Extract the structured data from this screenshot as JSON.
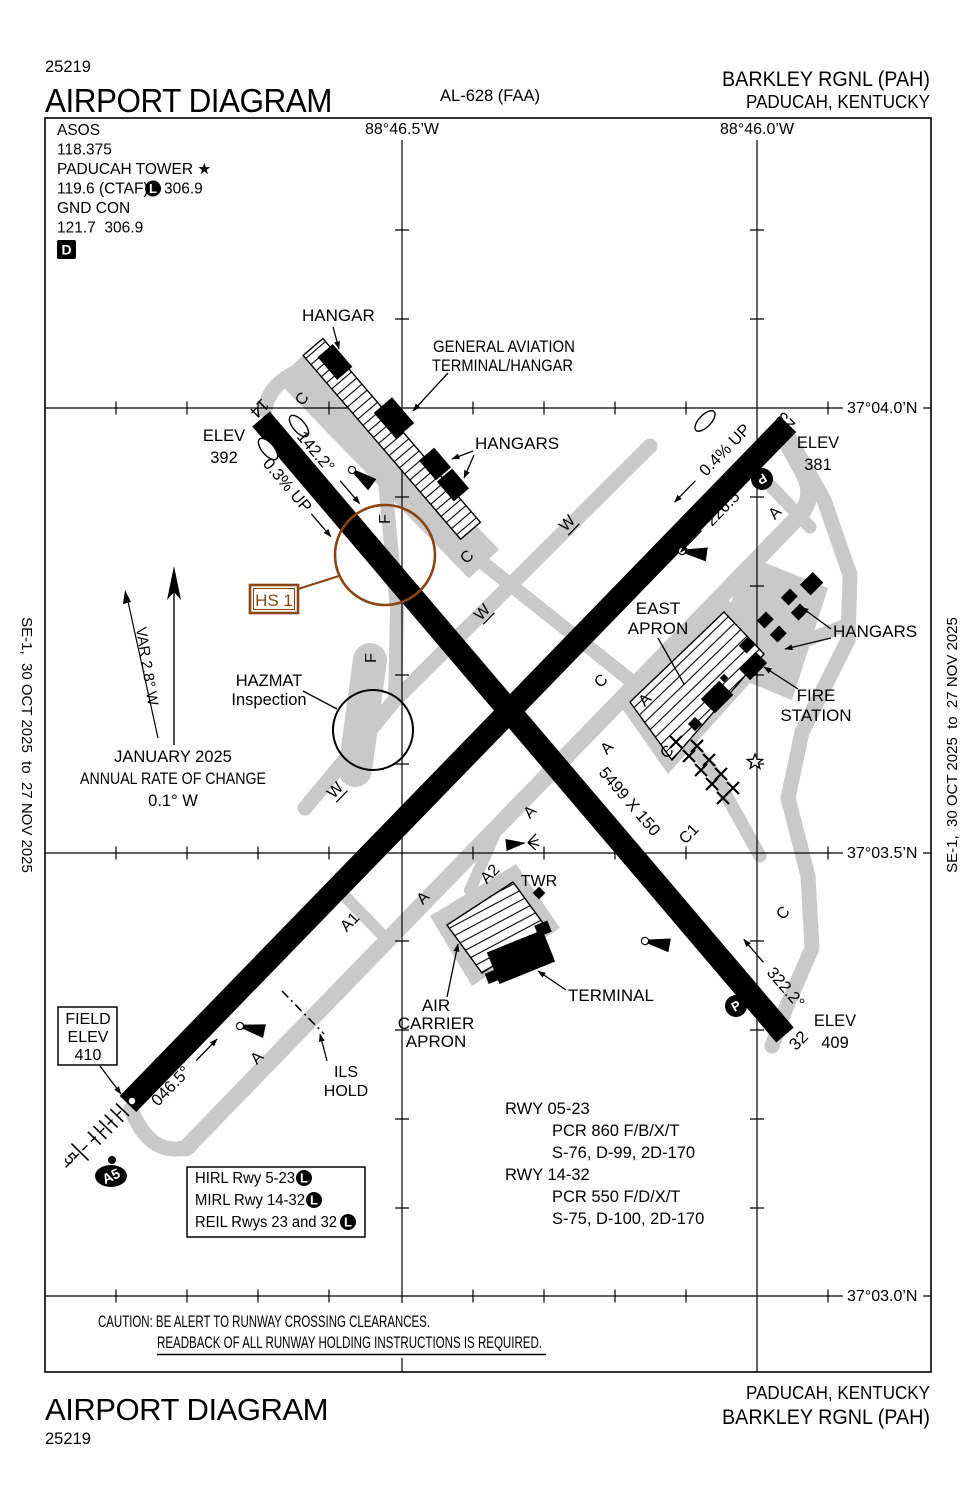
{
  "colors": {
    "hotspot_brown": "#8b4513",
    "taxiway_gray": "#c9c9c9",
    "ink": "#000000"
  },
  "header": {
    "chart_number": "25219",
    "title": "AIRPORT DIAGRAM",
    "al_ref": "AL-628 (FAA)",
    "airport": "BARKLEY RGNL (PAH)",
    "city": "PADUCAH, KENTUCKY"
  },
  "footer": {
    "title": "AIRPORT DIAGRAM",
    "chart_number": "25219",
    "city": "PADUCAH, KENTUCKY",
    "airport": "BARKLEY RGNL (PAH)"
  },
  "edition": {
    "note": "SE-1,  30 OCT 2025  to  27 NOV 2025"
  },
  "comm": {
    "asos_label": "ASOS",
    "asos_freq": "118.375",
    "tower_label": "PADUCAH TOWER ★",
    "tower_freq": "119.6 (CTAF)",
    "lighted": "L",
    "tower_freq_uhf": "306.9",
    "gnd_label": "GND CON",
    "gnd_freq": "121.7  306.9",
    "datis": "D"
  },
  "graticule": {
    "lon_465": "88°46.5’W",
    "lon_460": "88°46.0’W",
    "lat_040": "37°04.0’N",
    "lat_035": "37°03.5’N",
    "lat_030": "37°03.0’N"
  },
  "variation": {
    "var": "VAR 2.8° W",
    "date": "JANUARY 2025",
    "rate1": "ANNUAL RATE OF CHANGE",
    "rate2": "0.1° W"
  },
  "field": {
    "l1": "FIELD",
    "l2": "ELEV",
    "l3": "410"
  },
  "elevations": {
    "elev": "ELEV",
    "rwy14": "392",
    "rwy23": "381",
    "rwy32": "409"
  },
  "runways": {
    "num5": "5",
    "num14": "14",
    "num23": "23",
    "num32": "32",
    "hdg05": "046.5°",
    "hdg14": "142.2°",
    "hdg23": "226.5°",
    "hdg32": "322.2°",
    "slope14": "0.3% UP",
    "slope23": "0.4% UP",
    "dims0523": "6500 X 150",
    "dims1432": "5499 X 150"
  },
  "taxiways": {
    "a": "A",
    "a1": "A1",
    "a2": "A2",
    "a5": "A5",
    "c": "C",
    "c1": "C1",
    "f": "F",
    "w": "W"
  },
  "features": {
    "hangar": "HANGAR",
    "ga1": "GENERAL AVIATION",
    "ga2": "TERMINAL/HANGAR",
    "hangars": "HANGARS",
    "east1": "EAST",
    "east2": "APRON",
    "fire1": "FIRE",
    "fire2": "STATION",
    "twr": "TWR",
    "terminal": "TERMINAL",
    "air1": "AIR",
    "air2": "CARRIER",
    "air3": "APRON",
    "ils1": "ILS",
    "ils2": "HOLD",
    "hazmat1": "HAZMAT",
    "hazmat2": "Inspection",
    "hotspot": "HS 1",
    "parking": "P"
  },
  "lighting": {
    "line1": "HIRL Rwy 5-23",
    "line2": "MIRL Rwy 14-32",
    "line3": "REIL Rwys 23 and 32",
    "lighted": "L"
  },
  "runway_info": {
    "r1": "RWY 05-23",
    "r1_pcr": "PCR 860 F/B/X/T",
    "r1_acn": "S-76, D-99, 2D-170",
    "r2": "RWY 14-32",
    "r2_pcr": "PCR 550 F/D/X/T",
    "r2_acn": "S-75, D-100, 2D-170"
  },
  "caution": {
    "line1": "CAUTION: BE ALERT TO RUNWAY CROSSING CLEARANCES.",
    "line2": "READBACK OF ALL RUNWAY HOLDING INSTRUCTIONS IS REQUIRED."
  }
}
